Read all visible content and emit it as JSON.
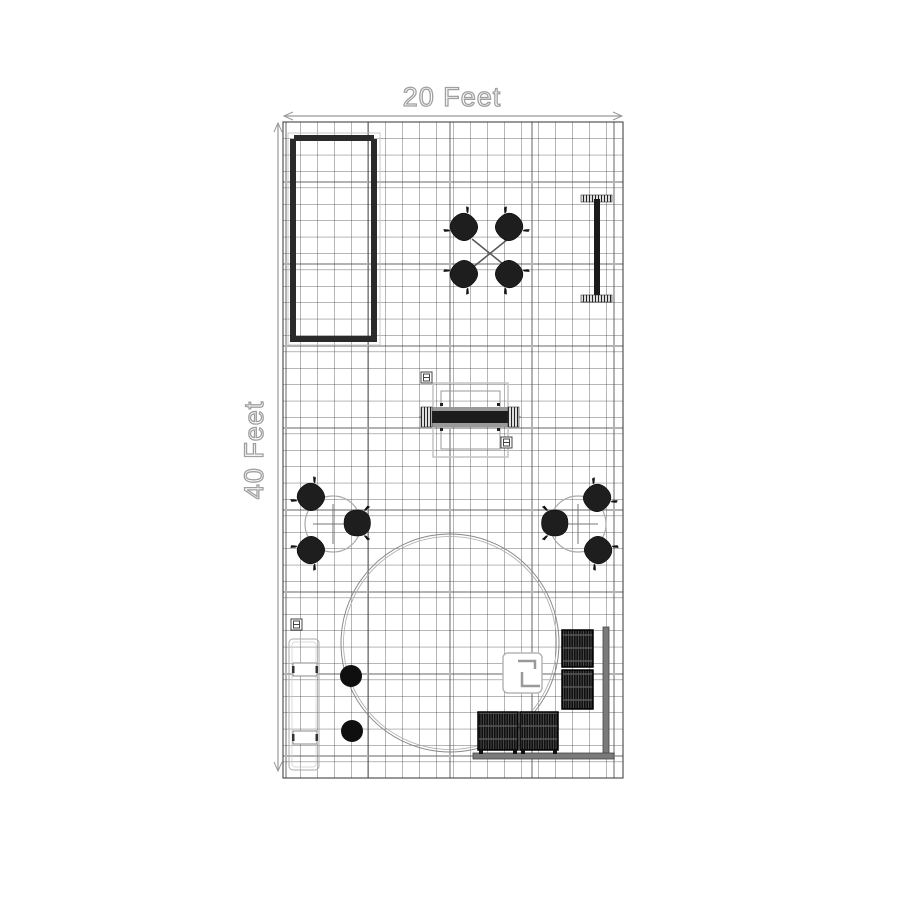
{
  "labels": {
    "width": "20 Feet",
    "height": "40 Feet"
  },
  "plan": {
    "booth_width_feet": 20,
    "booth_depth_feet": 40,
    "grid_cell_feet": 1,
    "grid_columns": 20,
    "grid_rows": 40,
    "colors": {
      "background": "#ffffff",
      "grid_minor": "#3d3d3d",
      "grid_major": "#b3b3b3",
      "furniture_dark": "#1e1e1e",
      "outline_gray": "#aaaaaa",
      "dimension_line": "#999999"
    },
    "furniture": [
      {
        "id": "storage-closet",
        "icon": "double-wall-rectangle-icon",
        "area": "top-left"
      },
      {
        "id": "cafe-table-4-chairs",
        "icon": "x-table-with-4-tub-chairs-icon",
        "chairs": 4,
        "area": "top-center"
      },
      {
        "id": "display-panel",
        "icon": "vertical-panel-with-connector-ends-icon",
        "area": "top-right"
      },
      {
        "id": "reception-counter",
        "icon": "counter-with-coil-ends-icon",
        "area": "center"
      },
      {
        "id": "round-table-3-chairs-left",
        "icon": "round-table-with-3-tub-chairs-icon",
        "chairs": 3,
        "area": "middle-left"
      },
      {
        "id": "round-table-3-chairs-right",
        "icon": "round-table-with-3-tub-chairs-icon",
        "chairs": 3,
        "area": "middle-right"
      },
      {
        "id": "hanging-sign-ring",
        "icon": "large-double-circle-icon",
        "area": "bottom-center"
      },
      {
        "id": "shelf-bench",
        "icon": "tall-rectangle-two-shelves-icon",
        "area": "bottom-left"
      },
      {
        "id": "ottoman-stools",
        "icon": "solid-circle-stool-icon",
        "count": 2,
        "area": "bottom-left"
      },
      {
        "id": "storage-cabinets",
        "icon": "hatched-square-cabinet-icon",
        "count": 4,
        "area": "bottom-right"
      },
      {
        "id": "equipment-stand",
        "icon": "rounded-square-corner-brackets-icon",
        "area": "inside-ring"
      },
      {
        "id": "power-outlets",
        "icon": "outlet-box-icon",
        "count": 3,
        "area": "center-and-bottom-left"
      }
    ]
  }
}
